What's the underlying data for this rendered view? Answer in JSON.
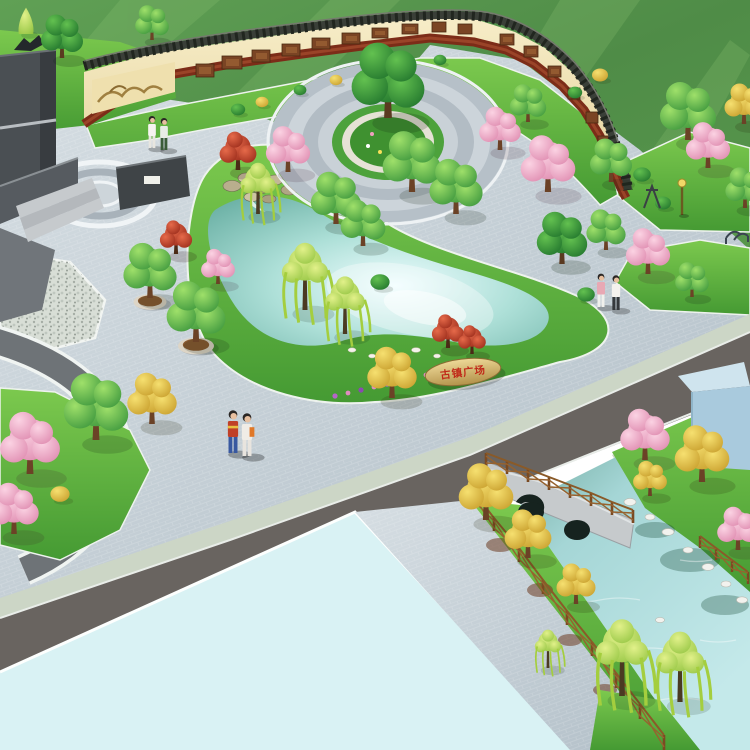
{
  "scene": {
    "type": "3d-landscape-architecture-rendering",
    "view": "aerial-birds-eye",
    "subject": "Ancient-town plaza park with mural screen wall, circular plaza, ponds and stream garden",
    "inscription_stone_text": "古镇广场",
    "feature_wall_plaque_text": ""
  },
  "palette": {
    "field_green": "#55923f",
    "lawn_green": "#5fae3c",
    "paving_grey_blue": "#c7d1d8",
    "path_dark_grey": "#6e7377",
    "road_asphalt": "#696460",
    "sidewalk_green_grey": "#ccd6c6",
    "flat_water_cyan": "#d9f2f4",
    "pond_water": "#9fd8d2",
    "stream_water": "#8cc4c0",
    "wall_face_cream": "#f0e4ba",
    "wall_coping_dark": "#3a3f38",
    "wall_base_red_brown": "#7c2c18",
    "mural_brown": "#7a4424",
    "monument_grey": "#4a4f53",
    "rock_tan": "#d2bb80",
    "inscription_red": "#c02818",
    "fence_wood_brown": "#8a5a28",
    "blossom_pink": "#f2b4cc",
    "maple_red": "#b83824",
    "tree_yellow": "#e6c33c",
    "willow_green": "#b5d94e",
    "planter_brown": "#96622f"
  },
  "elements": [
    {
      "name": "mural-screen-wall",
      "description": "curved cream wall with dark tile coping and relief mural panels"
    },
    {
      "name": "entry-monument",
      "description": "dark grey stone monument walls with sculpture and steps, top left"
    },
    {
      "name": "circular-plaza",
      "description": "concentric ring paving with central tree island"
    },
    {
      "name": "main-pond",
      "description": "kidney-shaped pond with rockery waterfall"
    },
    {
      "name": "inscription-stone",
      "description": "tan boulder engraved with red characters"
    },
    {
      "name": "feature-wall",
      "description": "dark stone wall with small white plaque beside the waterfall"
    },
    {
      "name": "tree-planters",
      "description": "round planters with clipped trees along the walk"
    },
    {
      "name": "left-garden-path",
      "description": "dark curved walkway looping a planting bed"
    },
    {
      "name": "pebble-mosaic-court",
      "description": "speckled paving patch at the west edge"
    },
    {
      "name": "ring-paving-motif",
      "description": "small oval paving inlay on the plaza"
    },
    {
      "name": "boulevard-road",
      "description": "asphalt road crossing the site diagonally"
    },
    {
      "name": "reflecting-water",
      "description": "large flat pale water surface, lower left"
    },
    {
      "name": "stone-arch-bridge",
      "description": "two-arch stone bridge where the road crosses the stream"
    },
    {
      "name": "timber-rail-fence",
      "description": "brown cross-braced wooden railings along the stream"
    },
    {
      "name": "stream-garden",
      "description": "stream with grass banks, white boulders, willows, yellow and pink trees"
    },
    {
      "name": "corner-building",
      "description": "pale blue block at the east edge"
    },
    {
      "name": "visitors",
      "description": "three pairs of pedestrians"
    },
    {
      "name": "street-lamp",
      "description": "small garden lamp on the east lawn"
    },
    {
      "name": "garden-bench",
      "description": "metal bench on the upper-right lawn"
    }
  ],
  "vegetation_types": [
    "round green tree",
    "dark green tree",
    "weeping willow",
    "pink blossom tree",
    "red maple",
    "yellow tree",
    "clipped shrub",
    "flower strip"
  ]
}
